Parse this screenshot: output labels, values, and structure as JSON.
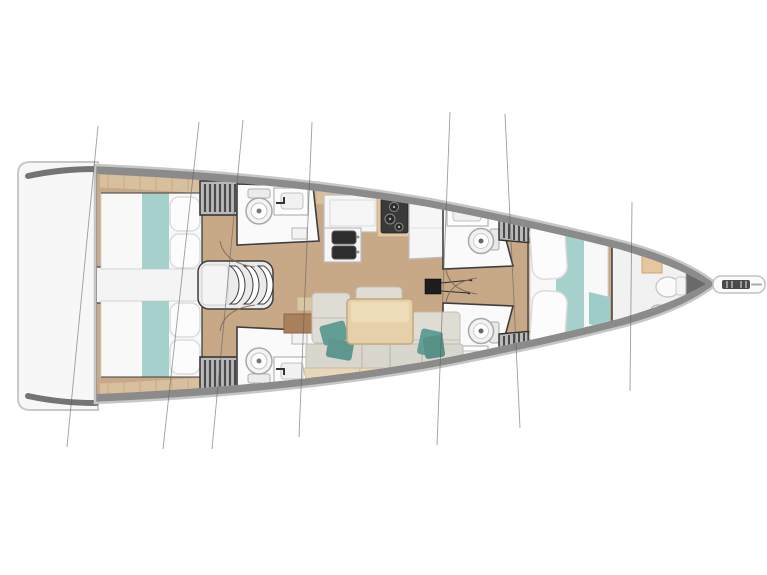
{
  "diagram": {
    "subject": "sailing-yacht-interior-floor-plan",
    "orientation": "bow-right",
    "features": [
      "swim-platform",
      "transom",
      "aft-cabin-starboard",
      "aft-cabin-port",
      "companionway-steps",
      "corridor",
      "wardrobe-aft-starboard",
      "wardrobe-aft-port",
      "head-aft-starboard",
      "head-aft-port",
      "galley-counter",
      "galley-double-sink",
      "stove",
      "fridge-counter",
      "salon-table",
      "salon-sofa",
      "head-forward-starboard",
      "head-forward-port",
      "wardrobe-forward-starboard",
      "wardrobe-forward-port",
      "mast-foot",
      "forward-cabin-berth",
      "bow-head",
      "bowsprit",
      "anchor-roller",
      "rigging-lines"
    ],
    "rigging_line_count": 7
  },
  "colors": {
    "background": "#ffffff",
    "hull_rim": "#8b8b8b",
    "hull_rim_dark": "#5d5d5d",
    "hull_outline": "#c6c6c6",
    "platform": "#f7f7f7",
    "platform_stroke": "#c8c8c8",
    "wood_floor": "#c7a887",
    "deck_band": "#d8c09f",
    "plank_seam": "#bb9c78",
    "room_white": "#fafafa",
    "wall_line": "#3e3e3e",
    "fixture_stroke": "#a8a8a8",
    "appliance_dark": "#2d2d2d",
    "stove_frame": "#dfc7a2",
    "bed_white": "#f8f8f8",
    "bed_teal": "#a5d0cc",
    "teal_accent": "#9ccdc8",
    "pillow_stroke": "#dcdcdc",
    "sofa_seat": "#d9d7cd",
    "sofa_back": "#e8d8ba",
    "cushion": "#dedcd3",
    "cushion_stroke": "#c2bfb3",
    "table_wood": "#e5d0a9",
    "table_stroke": "#c3a87e",
    "teal_pillow": "#639e96",
    "cabinet_brown": "#a97f5c",
    "locker_beige": "#e6c69e",
    "wardrobe_gray": "#b9b9b9",
    "wardrobe_stripe": "#4a4a4a",
    "steps_gray": "#ebebeb",
    "rigging_line": "#5f5f5f",
    "bow_wedge": "#6a6a6a",
    "door_arc": "#7d6c52"
  }
}
